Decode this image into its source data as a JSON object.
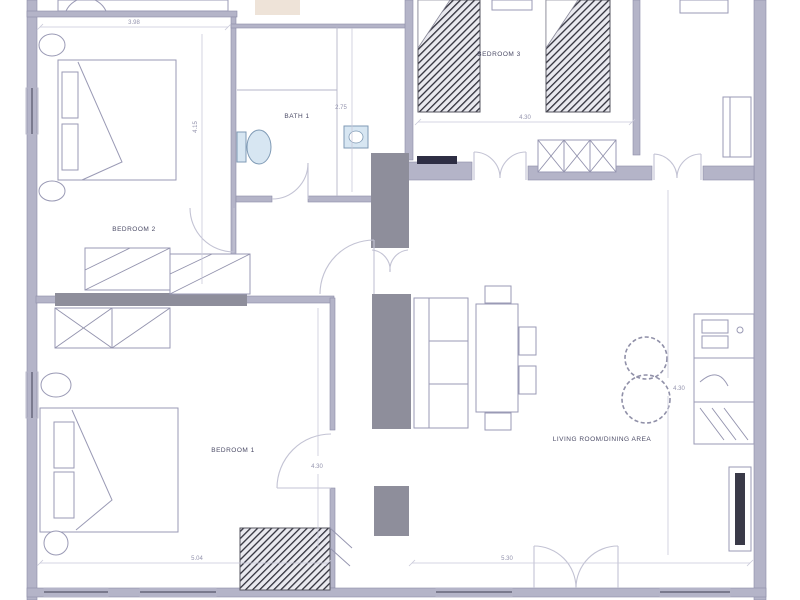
{
  "plan": {
    "type": "architectural floor plan, partial apartment view",
    "colors": {
      "background": "#ffffff",
      "wall": "#b4b4c8",
      "wall_dark": "#8e8e9b",
      "threshold_dark": "#2e2e44",
      "furniture_line": "#9a9ab5",
      "door_line": "#c3c3d4",
      "dim_line": "#c9c9da",
      "fixture_fill": "#d7e6f2",
      "fixture_stroke": "#7f9ab5",
      "hatch_dark": "#2f2f3a",
      "label_text": "#4b4b66",
      "dim_text": "#9393ad",
      "accent_smudge": "#d9c0a8"
    },
    "rooms": {
      "bedroom2": {
        "label": "BEDROOM 2"
      },
      "bath1": {
        "label": "BATH 1"
      },
      "bedroom3": {
        "label": "BEDROOM 3"
      },
      "bedroom1": {
        "label": "BEDROOM 1"
      },
      "living": {
        "label": "LIVING ROOM/DINING AREA"
      }
    },
    "dimensions": {
      "bedroom2_width": "3.98",
      "bedroom2_depth": "4.15",
      "bath_depth": "2.75",
      "bedroom3_width": "4.30",
      "living_depth": "4.30",
      "bedroom1_depth": "4.30",
      "bedroom1_width": "5.04",
      "living_width": "5.30"
    }
  }
}
